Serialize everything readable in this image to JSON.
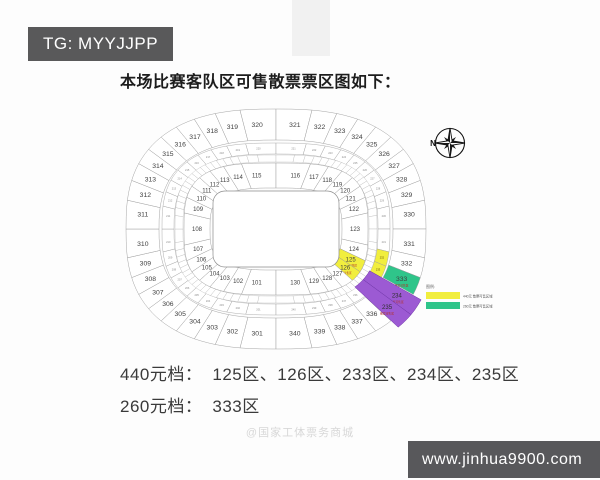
{
  "badges": {
    "telegram": "TG: MYYJJPP",
    "website": "www.jinhua9900.com"
  },
  "title": "本场比赛客队区可售散票票区图如下：",
  "pricing": {
    "tier1": {
      "label": "440元档：",
      "sections": "125区、126区、233区、234区、235区"
    },
    "tier2": {
      "label": "260元档：",
      "sections": "333区"
    }
  },
  "watermark": "@国家工体票务商城",
  "legend": {
    "title": "图例:",
    "items": [
      {
        "color": "#f1ee3e",
        "label": "440元 散票可售区域"
      },
      {
        "color": "#2fc58a",
        "label": "260元 散票可售区域"
      }
    ]
  },
  "colors": {
    "yellow": "#f1ee3e",
    "green": "#2fc58a",
    "purple": "#9c5ad3",
    "line": "#9a9a9a",
    "label": "#3f3f3f",
    "highlight_text": "#b23229"
  },
  "stadium": {
    "compass_label": "N",
    "highlight_subtext": "散票可售区",
    "inner_ring": {
      "start": 101,
      "count": 30,
      "yellow": [
        125,
        126
      ]
    },
    "middle_ring": {
      "start": 201,
      "count": 40,
      "yellow": [
        232,
        233
      ],
      "skip": [
        234,
        235
      ]
    },
    "outer_ring": {
      "start": 301,
      "count": 40,
      "green": [
        333
      ],
      "skip": [
        334,
        335
      ]
    },
    "purple_cells": [
      {
        "label": "234"
      },
      {
        "label": "235"
      }
    ]
  }
}
